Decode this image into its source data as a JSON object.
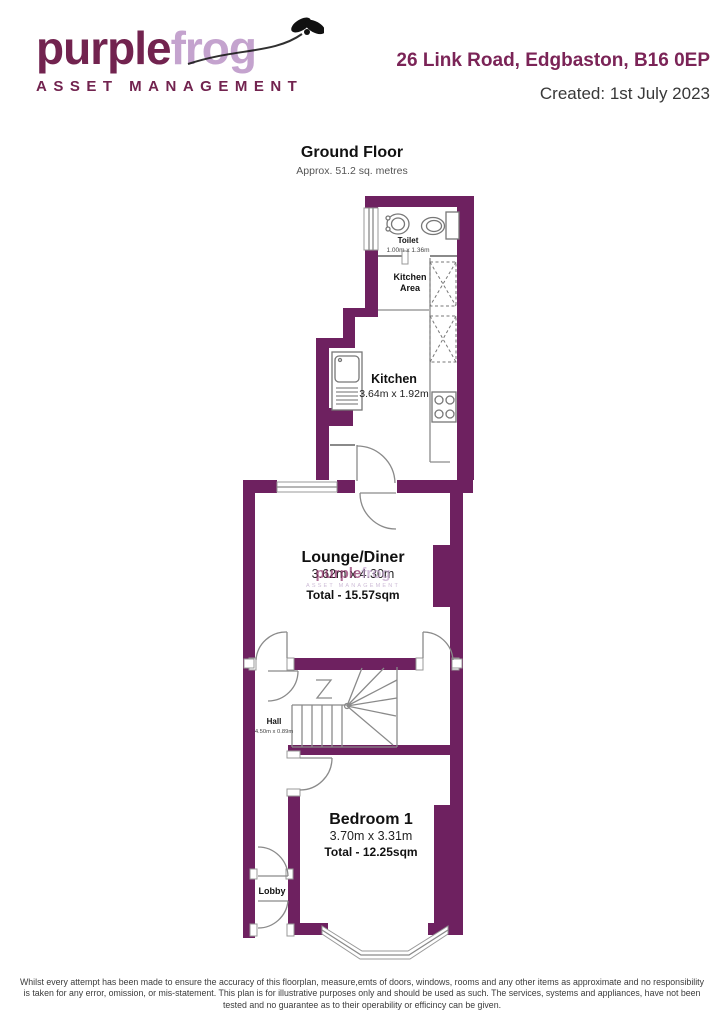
{
  "header": {
    "logo": {
      "word1": "purple",
      "word2": "frog",
      "tagline": "ASSET MANAGEMENT"
    },
    "address": "26 Link Road, Edgbaston, B16 0EP",
    "created": "Created: 1st July 2023"
  },
  "plan": {
    "title": "Ground Floor",
    "subtitle": "Approx. 51.2 sq. metres",
    "rooms": {
      "toilet": {
        "name": "Toilet",
        "dims": "1.00m x 1.36m"
      },
      "kitchen_area": {
        "name_line1": "Kitchen",
        "name_line2": "Area"
      },
      "kitchen": {
        "name": "Kitchen",
        "dims": "3.64m x 1.92m"
      },
      "lounge": {
        "name": "Lounge/Diner",
        "dims": "3.62m x 4.30m",
        "total": "Total - 15.57sqm"
      },
      "stairs": {
        "dims": "1.71m x 3.31m"
      },
      "hall": {
        "name": "Hall",
        "dims": "4.50m x 0.89m"
      },
      "bedroom": {
        "name": "Bedroom 1",
        "dims": "3.70m x 3.31m",
        "total": "Total - 12.25sqm"
      },
      "lobby": {
        "name": "Lobby"
      }
    },
    "watermark": {
      "word1": "purple",
      "word2": "frog",
      "tagline": "ASSET MANAGEMENT"
    },
    "icons": [
      "fly-icon",
      "wc-toilet-icon",
      "basin-icon",
      "kitchen-sink-icon",
      "hob-icon",
      "appliance-box-icon",
      "stairs-icon",
      "door-arc-icon",
      "window-icon",
      "bay-window-icon"
    ]
  },
  "colors": {
    "wall": "#6e2160",
    "brand_dark": "#72234f",
    "brand_light": "#c4a3ce"
  },
  "footer": {
    "disclaimer": "Whilst every attempt has been made to ensure the accuracy of this floorplan, measure,emts of doors, windows, rooms and any other items as approximate and no responsibility is taken for any error, omission, or mis-statement. This plan is for illustrative purposes only and should be used as such. The services, systems and appliances, have not been tested and no guarantee as to their operability or efficincy can be given."
  }
}
